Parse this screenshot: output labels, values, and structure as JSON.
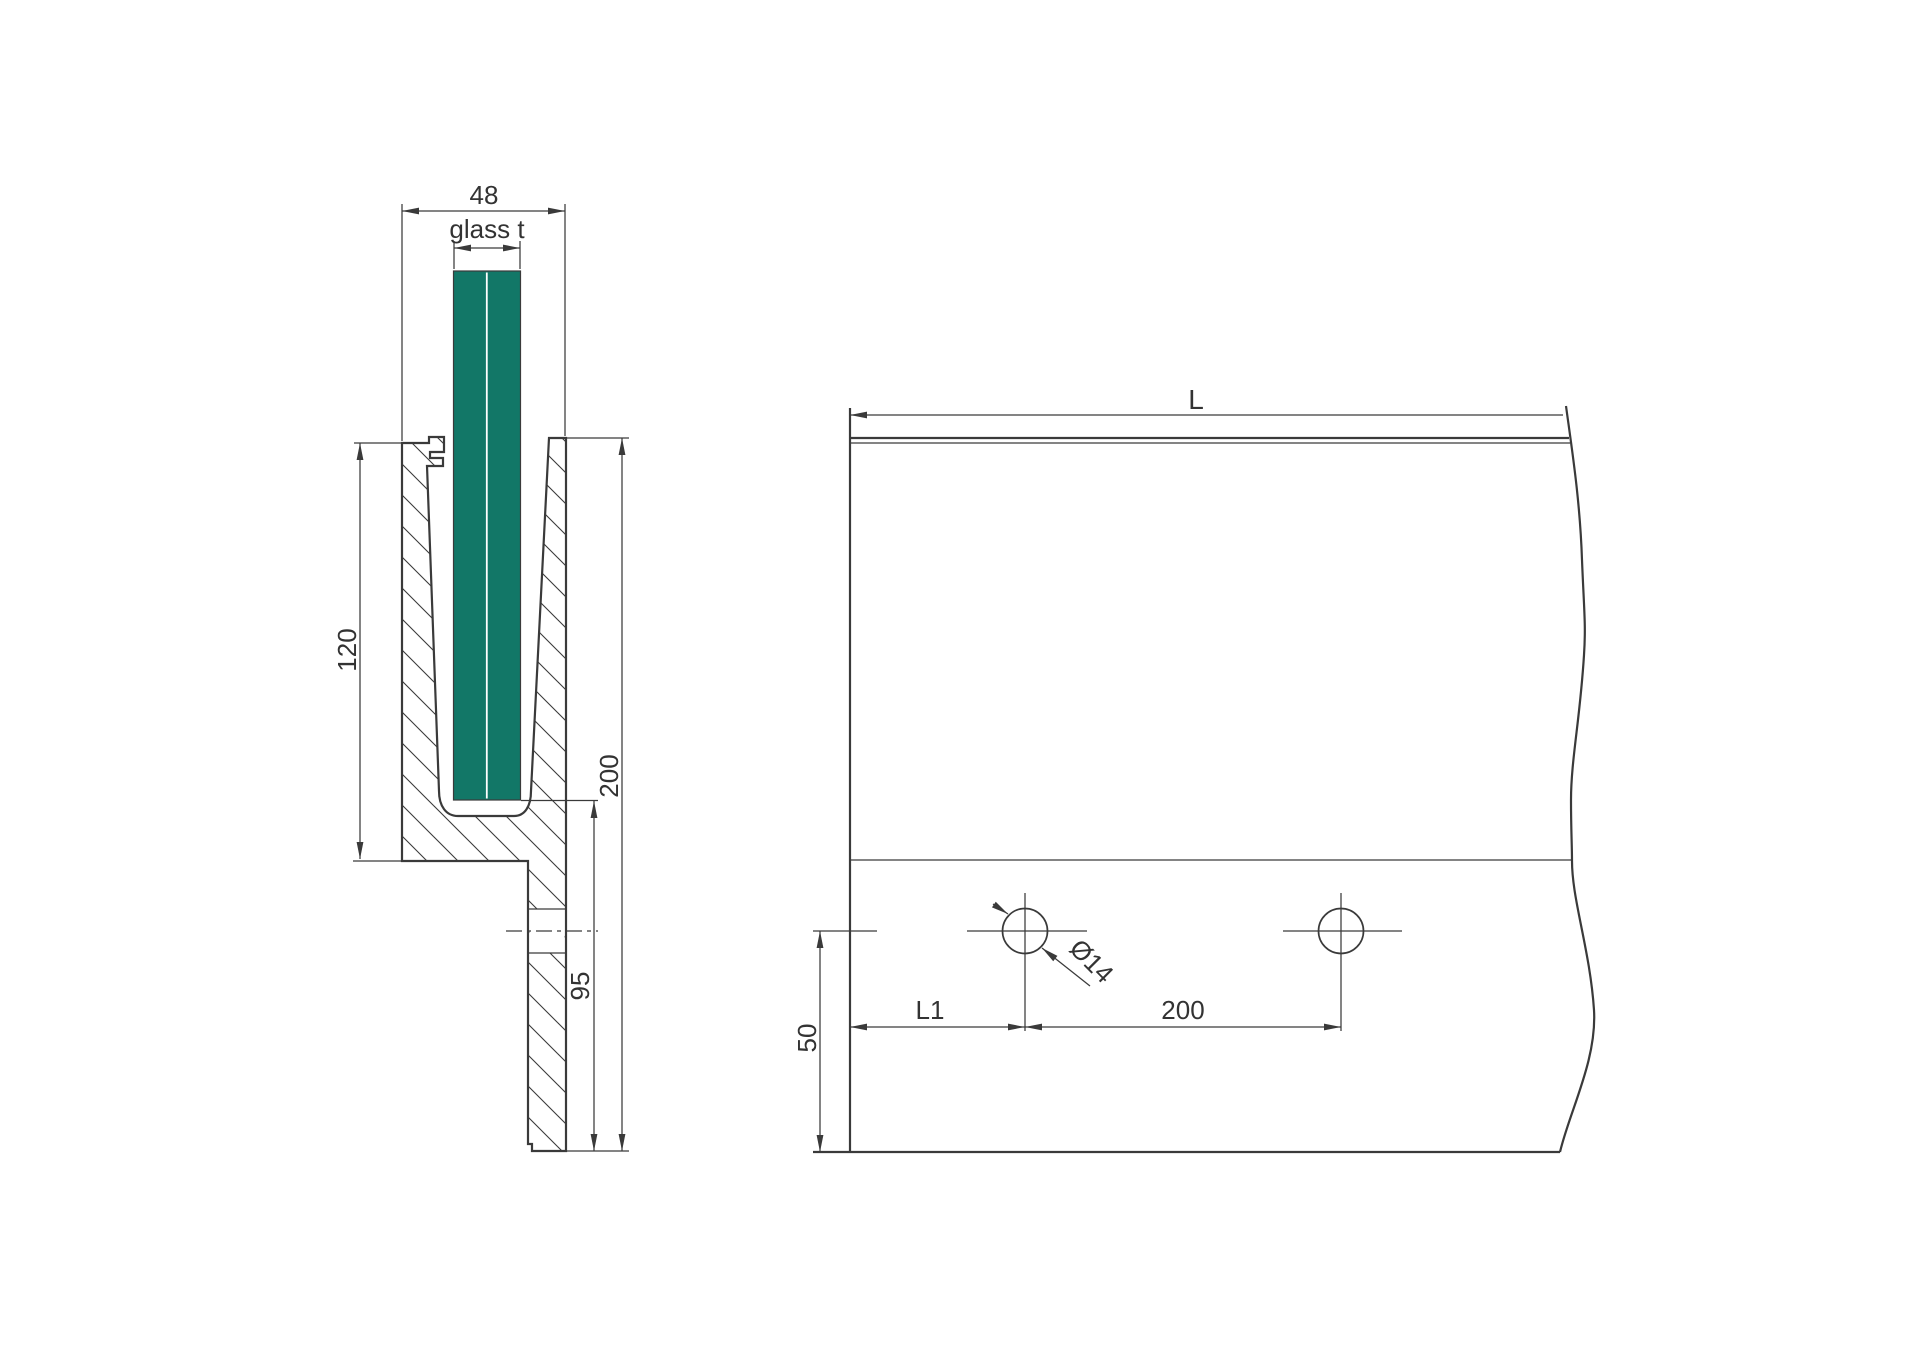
{
  "colors": {
    "background": "#ffffff",
    "line": "#3a3a3a",
    "text": "#333333",
    "glass": "#127767"
  },
  "section_view": {
    "outer_width": "48",
    "glass_thickness": "glass t",
    "front_height": "120",
    "total_height": "200",
    "drop_height": "95"
  },
  "elevation_view": {
    "length": "L",
    "end_hole_offset": "L1",
    "hole_spacing": "200",
    "hole_bottom_offset": "50",
    "hole_diameter": "Ø14"
  }
}
